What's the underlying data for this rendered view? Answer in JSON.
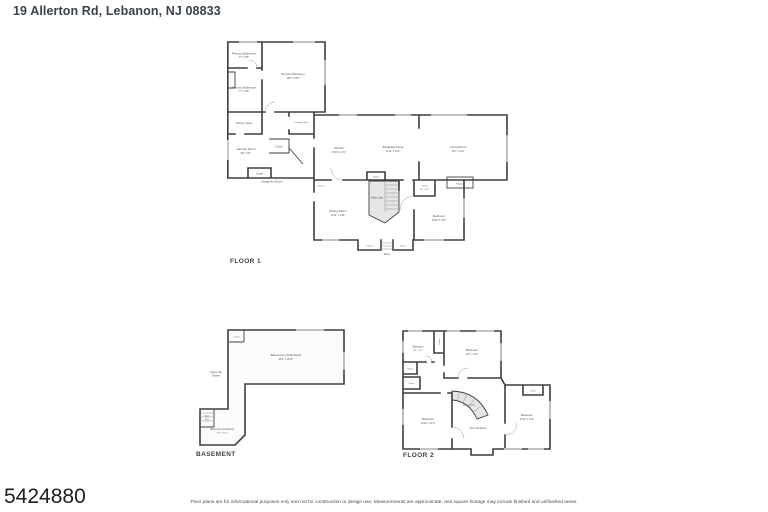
{
  "colors": {
    "wall": "#3e3e3e",
    "window": "#c7c7c7",
    "stairs_fill": "#e6e6e6",
    "title_text": "#3b424c",
    "label_text": "#4f4f4f"
  },
  "page": {
    "title": "19 Allerton Rd, Lebanon, NJ 08833",
    "listing_number": "5424880",
    "disclaimer": "Floor plans are for informational purposes only and not for construction or design use. Measurements are approximate, and square footage may include finished and unfinished areas."
  },
  "floor1": {
    "label": "FLOOR 1",
    "rooms": {
      "primary_bathroom_a": {
        "name": "Primary Bathroom",
        "dims": "7'7\" x 5'6\""
      },
      "primary_bathroom_b": {
        "name": "Primary Bathroom",
        "dims": "7'7\" x 9'6\""
      },
      "primary_bedroom": {
        "name": "Primary Bedroom",
        "dims": "13'8\" x 15'2\""
      },
      "primary_closet_a": {
        "name": "Primary Closet"
      },
      "primary_closet_b": {
        "name": "Primary Closet"
      },
      "laundry": {
        "name": "Laundry Room",
        "dims": "8'6\" x 9'4\""
      },
      "closet_laundry": {
        "name": "Closet"
      },
      "closet_garage": {
        "name": "Closet"
      },
      "garage_note": {
        "name": "Garage Not Shown"
      },
      "kitchen": {
        "name": "Kitchen",
        "dims": "10'10\" x 14'1\""
      },
      "breakfast_nook": {
        "name": "Breakfast Nook",
        "dims": "11'11\" x 14'1\""
      },
      "living_room": {
        "name": "Living Room",
        "dims": "19'1\" x 14'1\""
      },
      "pantry": {
        "name": "Pantry"
      },
      "closet_stairs": {
        "name": "Closet"
      },
      "stairs": {
        "name": "Stairs (Up)"
      },
      "closet_bedroom": {
        "name": "Closet",
        "dims": "4'6\" x 3'3\""
      },
      "fireplace": {
        "name": "Fireplace"
      },
      "dining_room": {
        "name": "Dining Room",
        "dims": "11'11\" x 13'0\""
      },
      "bedroom": {
        "name": "Bedroom",
        "dims": "10'10\" x 13'0\""
      },
      "closet_entry_a": {
        "name": "Closet"
      },
      "closet_entry_b": {
        "name": "Closet"
      },
      "entry": {
        "name": "Entry"
      }
    }
  },
  "basement": {
    "label": "BASEMENT",
    "rooms": {
      "closet": {
        "name": "Closet"
      },
      "basement_unfinished": {
        "name": "Basement (Unfinished)",
        "dims": "36'1\" x 16'10\""
      },
      "space_note_line1": "Space Not",
      "space_note_line2": "Shown",
      "stairs_line1": "Stairs",
      "stairs_line2": "(Up)",
      "basement_finished": {
        "name": "Basement (Finished)",
        "dims": "17'4\" x 11'2\""
      }
    }
  },
  "floor2": {
    "label": "FLOOR 2",
    "rooms": {
      "bathroom": {
        "name": "Bathroom",
        "dims": "8'2\" x 5'4\""
      },
      "closet_top": {
        "name": "Closet"
      },
      "bedroom_top": {
        "name": "Bedroom",
        "dims": "11'6\" x 10'4\""
      },
      "closet_left_a": {
        "name": "Closet"
      },
      "closet_left_b": {
        "name": "Closet"
      },
      "bedroom_left": {
        "name": "Bedroom",
        "dims": "12'10\" x 11'6\""
      },
      "stairs": {
        "name": "Stairs (Down)"
      },
      "open_to_below": {
        "name": "Open To Below"
      },
      "bedroom_right": {
        "name": "Bedroom",
        "dims": "11'10\" x 13'2\""
      },
      "closet_right": {
        "name": "Closet"
      }
    }
  }
}
